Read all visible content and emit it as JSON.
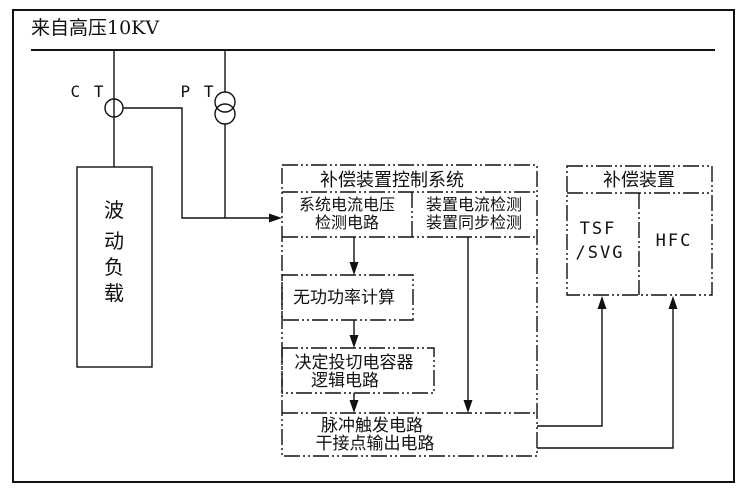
{
  "colors": {
    "background": "#ffffff",
    "line": "#111111",
    "text": "#111111"
  },
  "diagram": {
    "bus_label": "来自高压10KV",
    "ct_label": "C T",
    "pt_label": "P T",
    "load_box": {
      "chars": [
        "波",
        "动",
        "负",
        "载"
      ]
    },
    "control_box": {
      "title": "补偿装置控制系统",
      "system_detect": {
        "line1": "系统电流电压",
        "line2": "检测电路"
      },
      "device_detect": {
        "line1": "装置电流检测",
        "line2": "装置同步检测"
      },
      "reactive_calc": "无功功率计算",
      "switch_logic": {
        "line1": "决定投切电容器",
        "line2": "逻辑电路"
      },
      "pulse_output": {
        "line1": "脉冲触发电路",
        "line2": "干接点输出电路"
      }
    },
    "comp_box": {
      "title": "补偿装置",
      "tsf": {
        "line1": "TSF",
        "line2": "/SVG"
      },
      "hfc_label": "HFC"
    }
  }
}
